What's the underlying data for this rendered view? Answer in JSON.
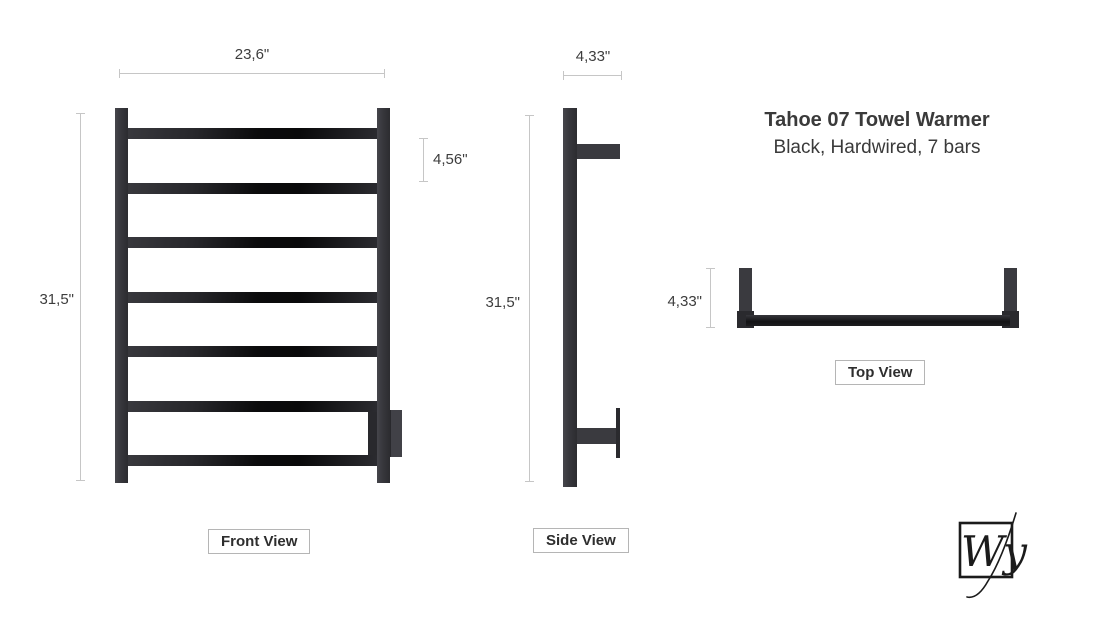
{
  "product": {
    "title": "Tahoe 07 Towel Warmer",
    "subtitle": "Black, Hardwired, 7 bars"
  },
  "views": {
    "front": {
      "label": "Front View",
      "width_dim": "23,6\"",
      "height_dim": "31,5\"",
      "bar_spacing_dim": "4,56\"",
      "bar_count": 7
    },
    "side": {
      "label": "Side View",
      "depth_dim": "4,33\"",
      "height_dim": "31,5\""
    },
    "top": {
      "label": "Top View",
      "depth_dim": "4,33\""
    }
  },
  "logo": {
    "monogram": "Wy"
  },
  "colors": {
    "dim_line": "#c6c6c6",
    "text": "#3d3d3d",
    "label_border": "#b5b5b5",
    "metal_dark": "#2a2a2e",
    "metal_mid": "#3a3a3f",
    "gloss_black": "#0a0a0b",
    "logo_ink": "#1b1b1b"
  }
}
